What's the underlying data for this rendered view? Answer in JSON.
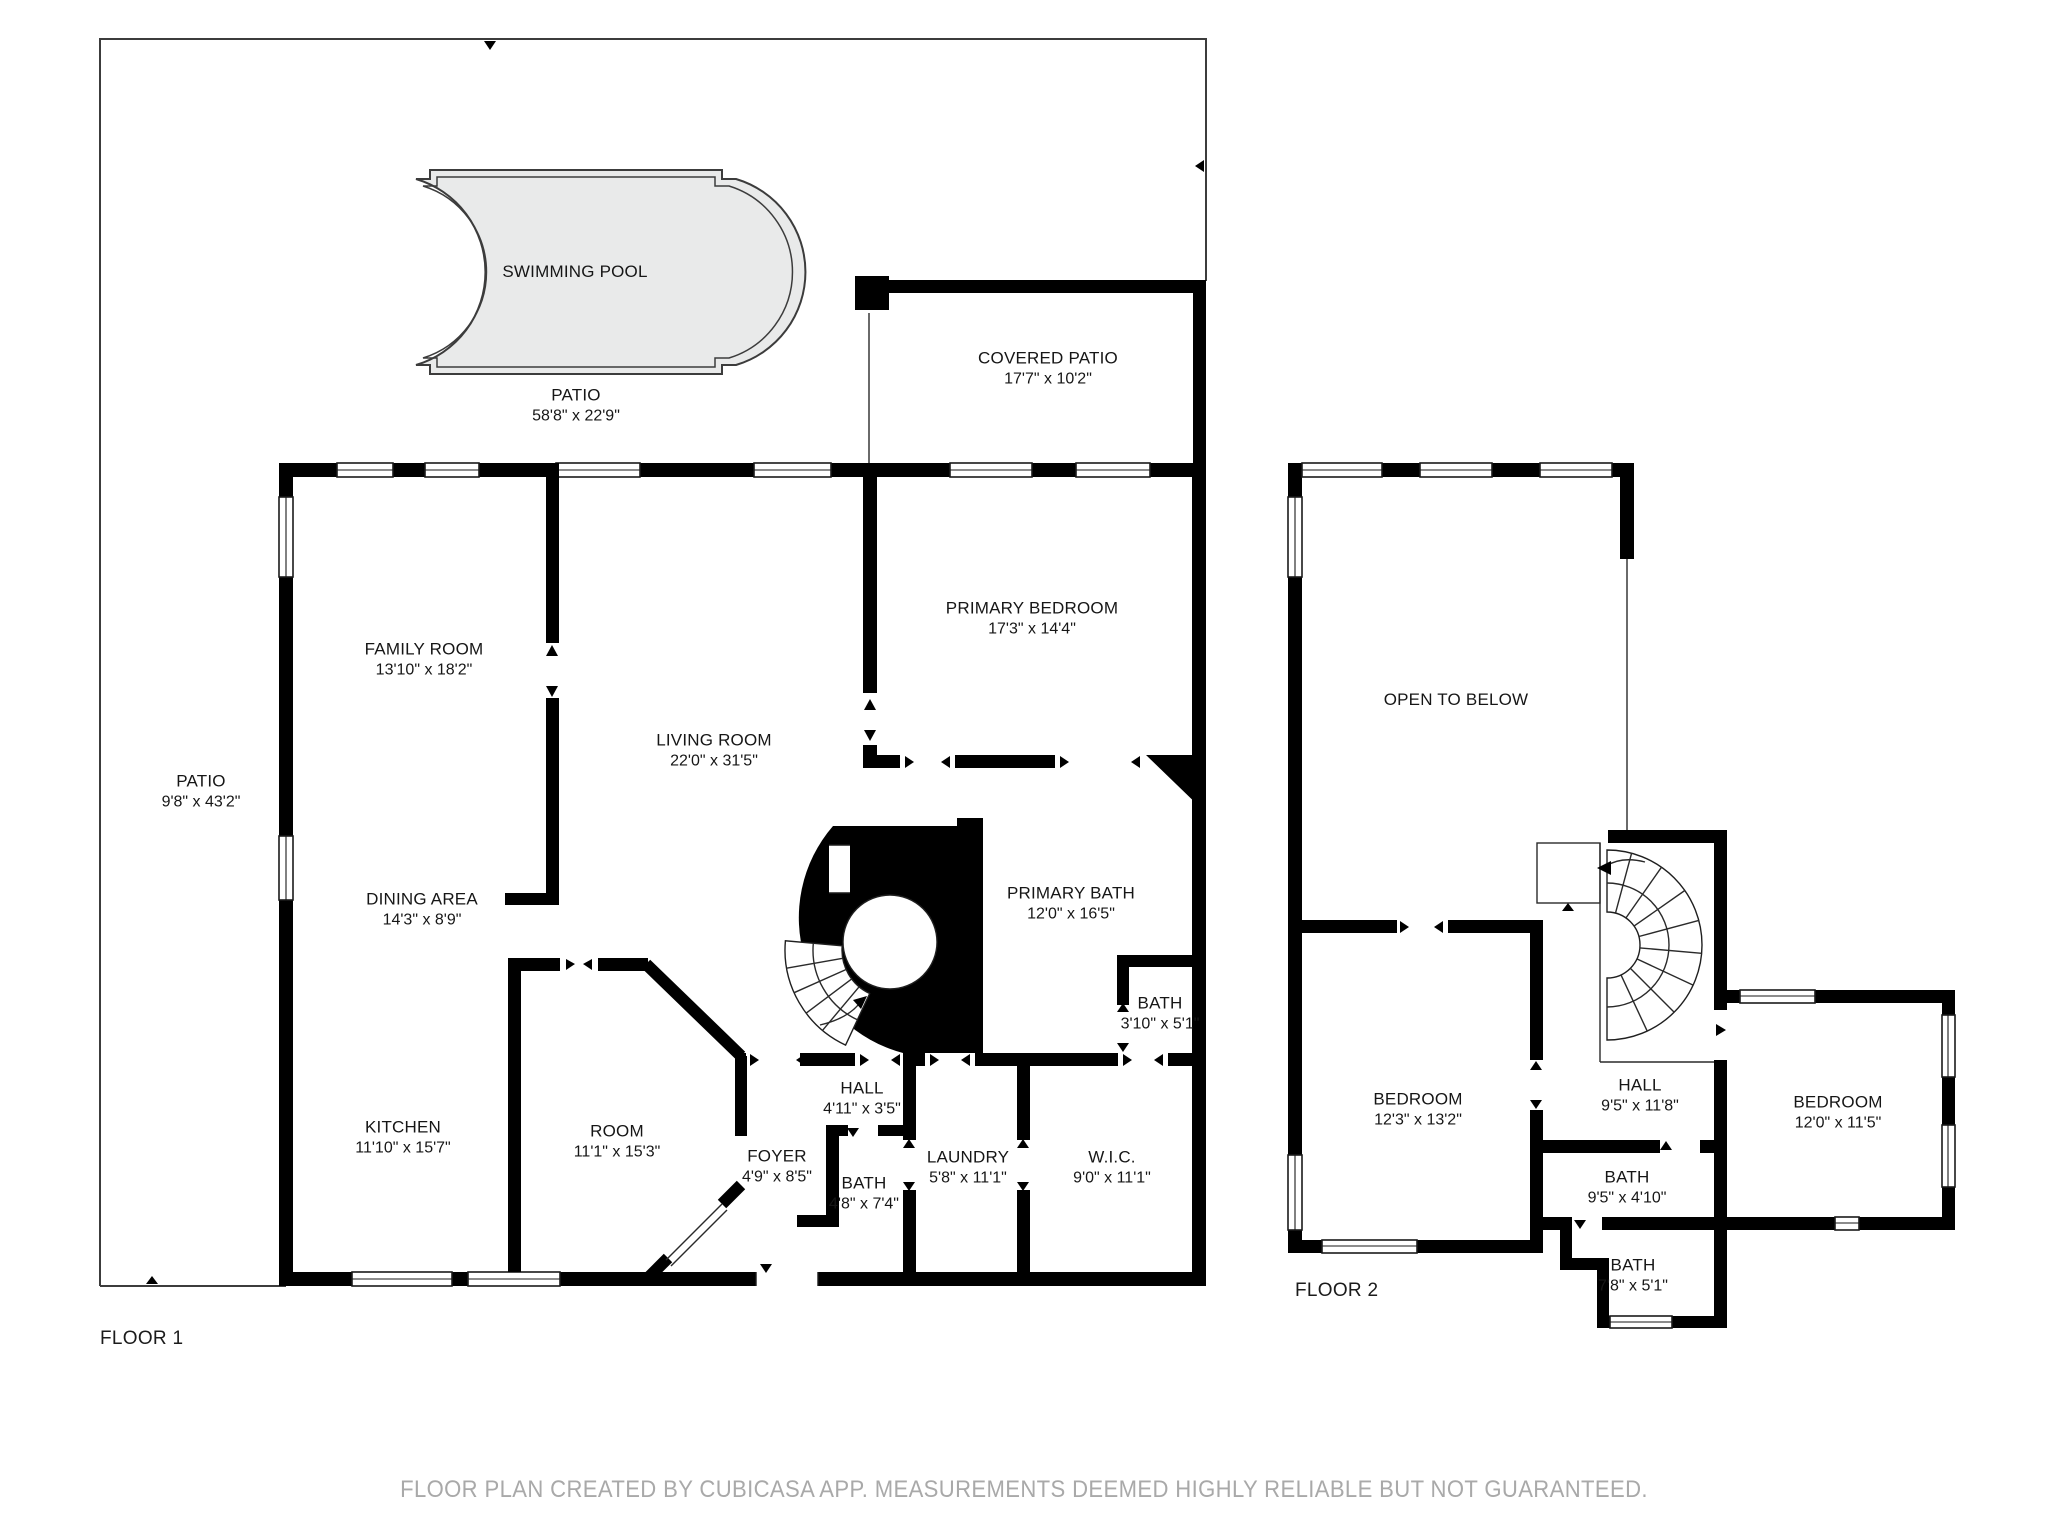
{
  "floor1": {
    "label": "FLOOR 1",
    "swimming_pool": {
      "name": "SWIMMING POOL"
    },
    "patio_pool": {
      "name": "PATIO",
      "dims": "58'8\" x 22'9\""
    },
    "covered_patio": {
      "name": "COVERED PATIO",
      "dims": "17'7\" x 10'2\""
    },
    "family_room": {
      "name": "FAMILY ROOM",
      "dims": "13'10\" x 18'2\""
    },
    "primary_bedroom": {
      "name": "PRIMARY BEDROOM",
      "dims": "17'3\" x 14'4\""
    },
    "living_room": {
      "name": "LIVING ROOM",
      "dims": "22'0\" x 31'5\""
    },
    "patio_side": {
      "name": "PATIO",
      "dims": "9'8\" x 43'2\""
    },
    "dining_area": {
      "name": "DINING AREA",
      "dims": "14'3\" x 8'9\""
    },
    "primary_bath": {
      "name": "PRIMARY BATH",
      "dims": "12'0\" x 16'5\""
    },
    "bath_2": {
      "name": "BATH",
      "dims": "3'10\" x 5'1\""
    },
    "kitchen": {
      "name": "KITCHEN",
      "dims": "11'10\" x 15'7\""
    },
    "room": {
      "name": "ROOM",
      "dims": "11'1\" x 15'3\""
    },
    "foyer": {
      "name": "FOYER",
      "dims": "4'9\" x 8'5\""
    },
    "hall": {
      "name": "HALL",
      "dims": "4'11\" x 3'5\""
    },
    "bath_1": {
      "name": "BATH",
      "dims": "4'8\" x 7'4\""
    },
    "laundry": {
      "name": "LAUNDRY",
      "dims": "5'8\" x 11'1\""
    },
    "wic": {
      "name": "W.I.C.",
      "dims": "9'0\" x 11'1\""
    }
  },
  "floor2": {
    "label": "FLOOR 2",
    "open_to_below": {
      "name": "OPEN TO BELOW"
    },
    "bedroom_left": {
      "name": "BEDROOM",
      "dims": "12'3\" x 13'2\""
    },
    "hall": {
      "name": "HALL",
      "dims": "9'5\" x 11'8\""
    },
    "bedroom_right": {
      "name": "BEDROOM",
      "dims": "12'0\" x 11'5\""
    },
    "bath_upper": {
      "name": "BATH",
      "dims": "9'5\" x 4'10\""
    },
    "bath_lower": {
      "name": "BATH",
      "dims": "7'8\" x 5'1\""
    }
  },
  "footer": "FLOOR PLAN CREATED BY CUBICASA APP. MEASUREMENTS DEEMED HIGHLY RELIABLE BUT NOT GUARANTEED.",
  "colors": {
    "wall": "#000000",
    "pool_fill": "#e9eaea",
    "footer_text": "#a9a9a9"
  }
}
